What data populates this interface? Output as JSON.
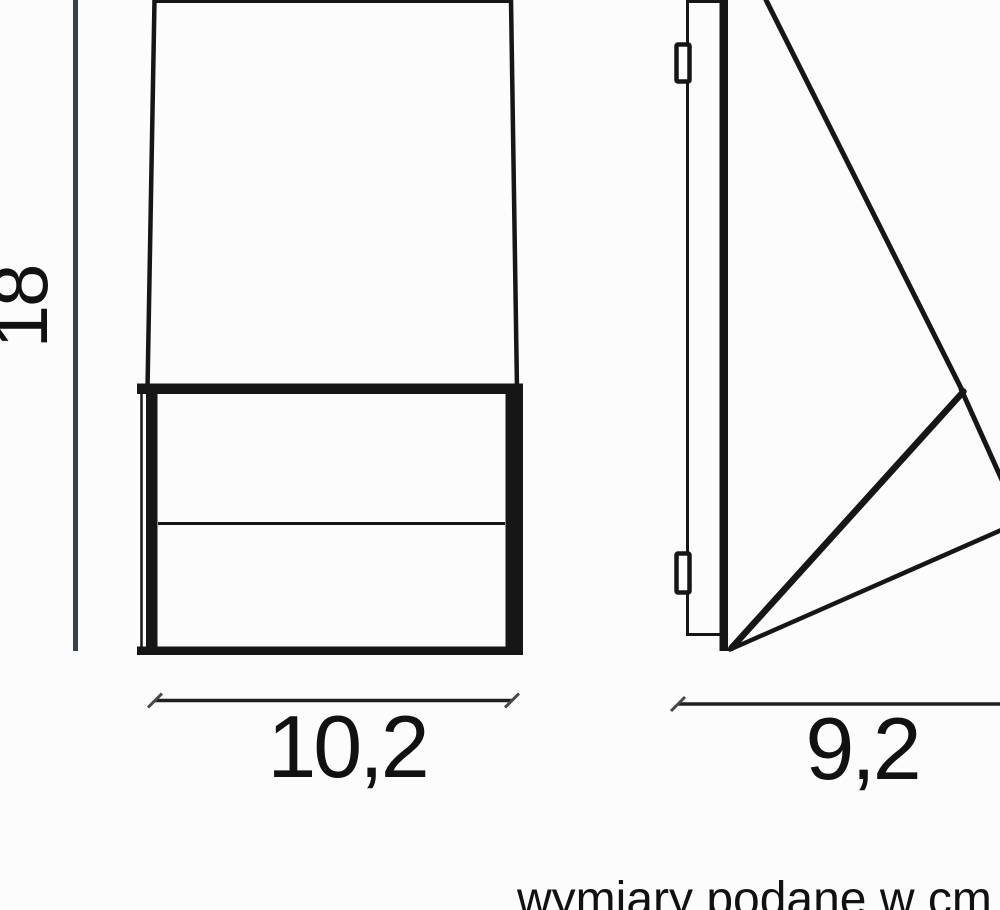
{
  "colors": {
    "line": "#161616",
    "dim_line": "#3b4045",
    "text": "#111111",
    "background": "#fcfcfc"
  },
  "dimensions": {
    "height": "18",
    "width": "10,2",
    "depth": "9,2"
  },
  "footnote": "wymiary podane w cm"
}
